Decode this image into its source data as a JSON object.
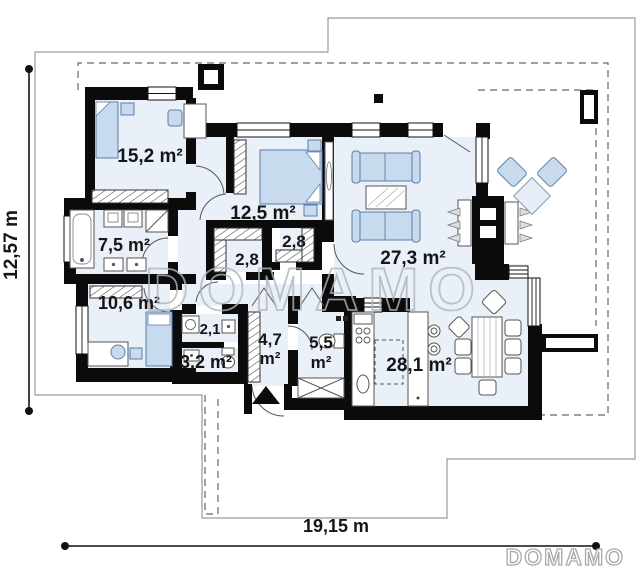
{
  "plan_type": "single-storey house floor plan",
  "labels": {
    "bedroom1": "15,2 m²",
    "bedroom2": "12,5 m²",
    "bathroom": "7,5 m²",
    "closet_left": "2,8",
    "closet_right": "2,8",
    "bedroom3": "10,6 m²",
    "laundry": "2,1",
    "wc": "3,2 m²",
    "hall_area": "4,7",
    "hall_unit": "m²",
    "bath_small_area": "5,5",
    "bath_small_unit": "m²",
    "living_room": "27,3 m²",
    "kitchen_dining": "28,1 m²"
  },
  "dimensions": {
    "left_vertical": "12,57 m",
    "bottom_horizontal": "19,15 m"
  },
  "watermark": {
    "center": "DOMAMO",
    "corner": "DOMAMO"
  },
  "colors": {
    "wall": "#0b0b0b",
    "room_fill": "#e9f0f8",
    "furniture_blue": "#c7daee",
    "watermark_gray": "#b0b4ba",
    "lot_line": "#9a9a9a"
  }
}
